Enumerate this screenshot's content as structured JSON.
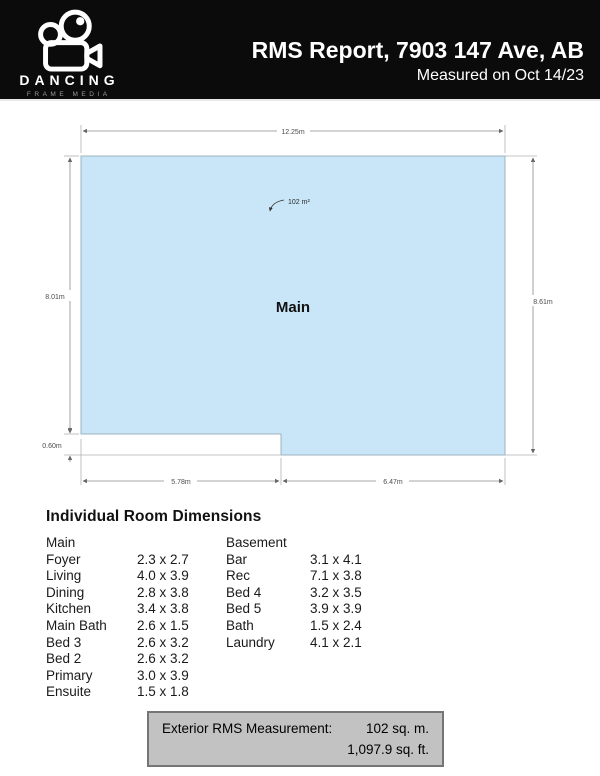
{
  "header": {
    "title": "RMS Report, 7903 147 Ave, AB",
    "subtitle": "Measured on Oct 14/23",
    "logo_name": "DANCING",
    "logo_sub": "FRAME MEDIA"
  },
  "plan": {
    "room_label": "Main",
    "area_label": "102 m²",
    "top_width": "12.25m",
    "left_height": "8.01m",
    "right_height": "8.61m",
    "notch_height": "0.60m",
    "bottom_left_width": "5.78m",
    "bottom_right_width": "6.47m",
    "fill_color": "#c9e6f8"
  },
  "rooms": {
    "heading": "Individual Room Dimensions",
    "columns": [
      {
        "group": "Main",
        "rows": [
          {
            "name": "Foyer",
            "dims": "2.3 x 2.7"
          },
          {
            "name": "Living",
            "dims": "4.0 x 3.9"
          },
          {
            "name": "Dining",
            "dims": "2.8 x 3.8"
          },
          {
            "name": "Kitchen",
            "dims": "3.4 x 3.8"
          },
          {
            "name": "Main Bath",
            "dims": "2.6 x 1.5"
          },
          {
            "name": "Bed 3",
            "dims": "2.6 x 3.2"
          },
          {
            "name": "Bed 2",
            "dims": "2.6 x 3.2"
          },
          {
            "name": "Primary",
            "dims": "3.0 x 3.9"
          },
          {
            "name": "Ensuite",
            "dims": "1.5 x 1.8"
          }
        ]
      },
      {
        "group": "Basement",
        "rows": [
          {
            "name": "Bar",
            "dims": "3.1 x 4.1"
          },
          {
            "name": "Rec",
            "dims": "7.1 x 3.8"
          },
          {
            "name": "Bed 4",
            "dims": "3.2 x 3.5"
          },
          {
            "name": "Bed 5",
            "dims": "3.9 x 3.9"
          },
          {
            "name": "Bath",
            "dims": "1.5 x 2.4"
          },
          {
            "name": "Laundry",
            "dims": "4.1 x 2.1"
          }
        ]
      }
    ]
  },
  "summary": {
    "label": "Exterior RMS Measurement:",
    "value_metric": "102 sq. m.",
    "value_imperial": "1,097.9 sq. ft."
  }
}
